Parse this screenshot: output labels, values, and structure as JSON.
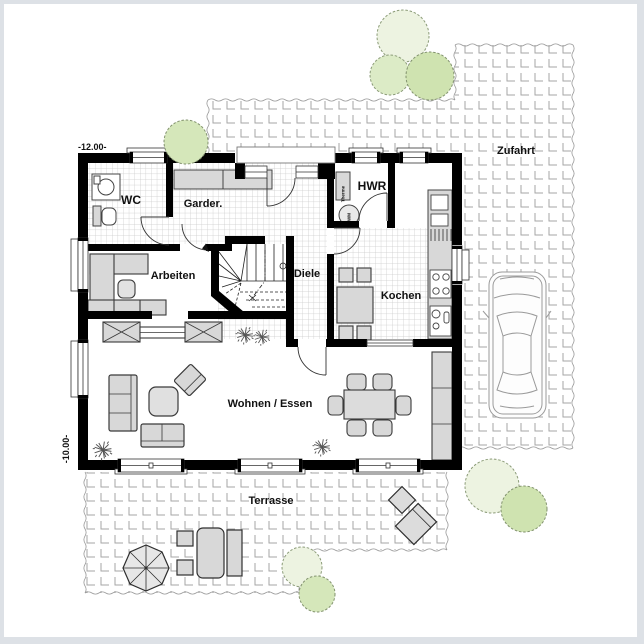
{
  "rooms": {
    "wc": "WC",
    "garderobe": "Garder.",
    "hwr": "HWR",
    "arbeiten": "Arbeiten",
    "diele": "Diele",
    "kochen": "Kochen",
    "wohnen_essen": "Wohnen / Essen"
  },
  "outdoor": {
    "zufahrt": "Zufahrt",
    "terrasse": "Terrasse"
  },
  "dimensions": {
    "left_top": "-12.00-",
    "left_bottom": "-10.00-"
  },
  "equipment": {
    "therme": "Therme",
    "washing_machine": "WM"
  },
  "colors": {
    "wall": "#000000",
    "furniture_fill": "#d8d8d8",
    "frame_border": "#dde1e6",
    "tile_line": "#c9c9c9",
    "paver_line": "#a6a6a6",
    "bush_light": "#edf3e1",
    "bush_green": "#d5e7ba",
    "car_outline": "#9a9a9a"
  }
}
